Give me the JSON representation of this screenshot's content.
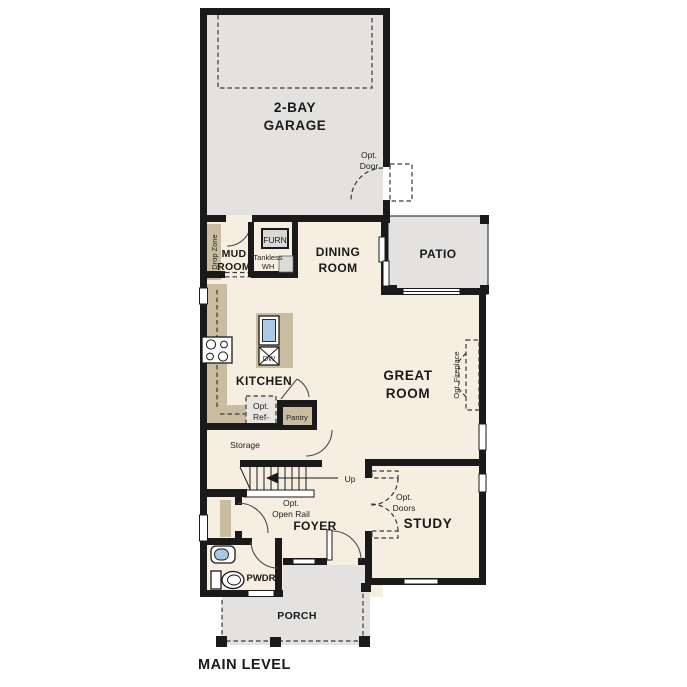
{
  "title": "MAIN LEVEL",
  "colors": {
    "interior_floor": "#f5eee1",
    "exterior_floor": "#e3e2e0",
    "counter_tan": "#c9bca1",
    "wall": "#1a1a1a",
    "sink_blue": "#a9c9e6"
  },
  "rooms": {
    "garage": {
      "line1": "2-BAY",
      "line2": "GARAGE"
    },
    "garage_door": {
      "line1": "Opt.",
      "line2": "Door"
    },
    "mud_room": {
      "line1": "MUD",
      "line2": "ROOM"
    },
    "drop_zone": {
      "label": "Drop Zone"
    },
    "furnace_closet": {
      "furnace": "FURN",
      "wh_line1": "Tankless",
      "wh_line2": "WH"
    },
    "dining_room": {
      "line1": "DINING",
      "line2": "ROOM"
    },
    "patio": {
      "label": "PATIO"
    },
    "kitchen": {
      "label": "KITCHEN",
      "dishwasher": "DW",
      "pantry": "Pantry",
      "opt_ref_line1": "Opt.",
      "opt_ref_line2": "Ref-"
    },
    "storage": {
      "label": "Storage"
    },
    "stairs": {
      "up": "Up",
      "rail_line1": "Opt.",
      "rail_line2": "Open Rail"
    },
    "great_room": {
      "line1": "GREAT",
      "line2": "ROOM",
      "fireplace": "Opt. Fireplace"
    },
    "study": {
      "label": "STUDY",
      "doors_line1": "Opt.",
      "doors_line2": "Doors"
    },
    "foyer": {
      "label": "FOYER"
    },
    "powder_room": {
      "label": "PWDR"
    },
    "porch": {
      "label": "PORCH"
    }
  }
}
